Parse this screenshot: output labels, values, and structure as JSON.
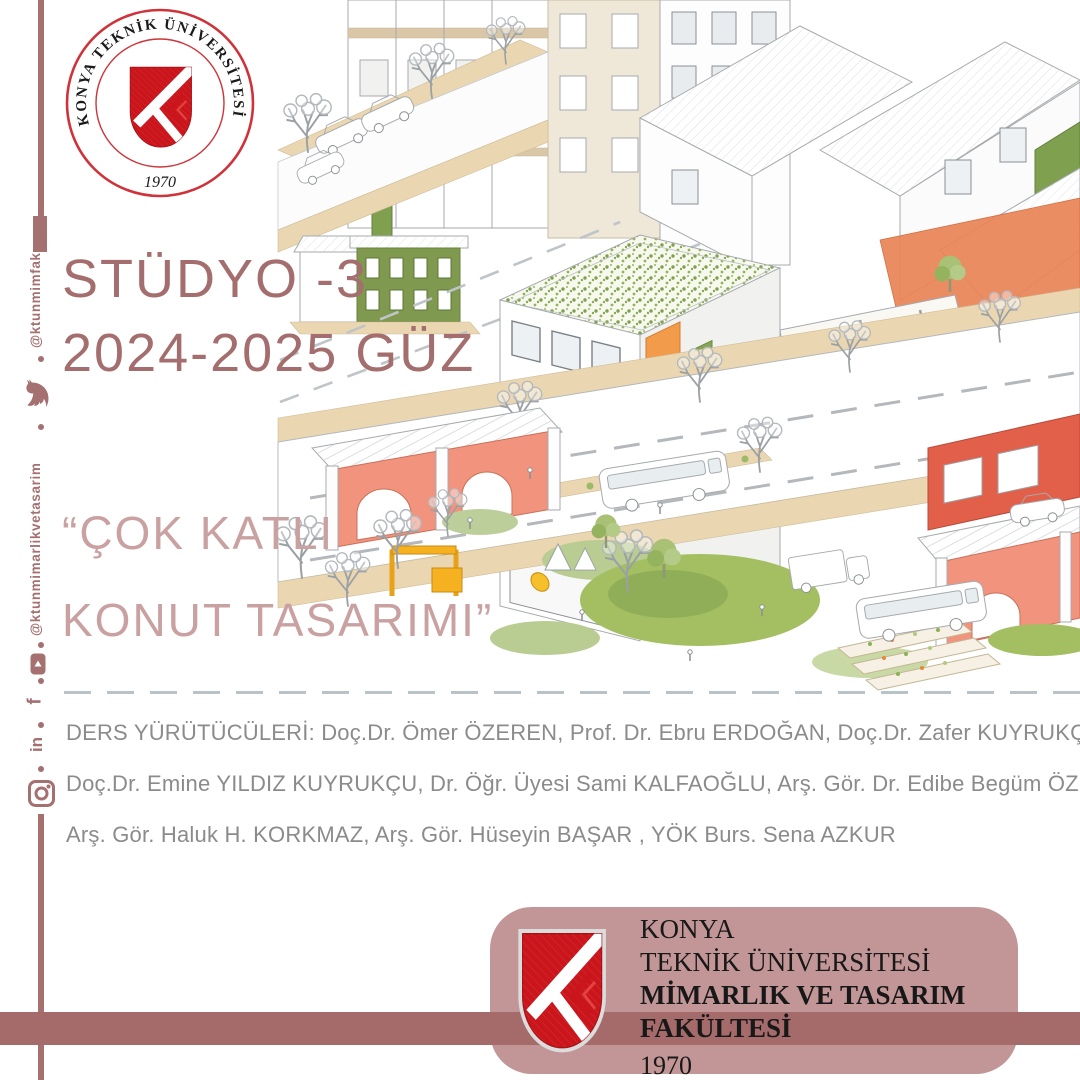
{
  "seal": {
    "ring_text": "KONYA TEKNİK ÜNİVERSİTESİ",
    "year": "1970"
  },
  "social": {
    "handle_top": "@ktunmimfak",
    "handle_bottom": "@ktunmimarlikvetasarim",
    "facebook_glyph": "f",
    "linkedin_glyph": "in"
  },
  "hero": {
    "studio_title": "STÜDYO -3",
    "term": "2024-2025 GÜZ",
    "quote_line1": "“ÇOK KATLI",
    "quote_line2": "KONUT TASARIMI”"
  },
  "instructors": {
    "line1": "DERS YÜRÜTÜCÜLERİ: Doç.Dr. Ömer ÖZEREN,  Prof. Dr. Ebru ERDOĞAN, Doç.Dr. Zafer KUYRUKÇU,",
    "line2": "Doç.Dr. Emine YILDIZ KUYRUKÇU, Dr. Öğr. Üyesi Sami KALFAOĞLU, Arş. Gör. Dr. Edibe Begüm ÖZEREN,",
    "line3": "Arş. Gör. Haluk H. KORKMAZ, Arş. Gör. Hüseyin BAŞAR , YÖK Burs. Sena AZKUR"
  },
  "footer": {
    "line1": "KONYA",
    "line2": "TEKNİK ÜNİVERSİTESİ",
    "line3": "MİMARLIK VE TASARIM",
    "line4": "FAKÜLTESİ",
    "year": "1970"
  },
  "colors": {
    "accent_mauve": "#a57070",
    "title_mauve": "#a46e6e",
    "quote_rose": "#c9a1a1",
    "band_dark": "#a56b6b",
    "card_rose": "#c29697",
    "logo_red": "#c9151b",
    "instructor_gray": "#8b8b8b"
  }
}
